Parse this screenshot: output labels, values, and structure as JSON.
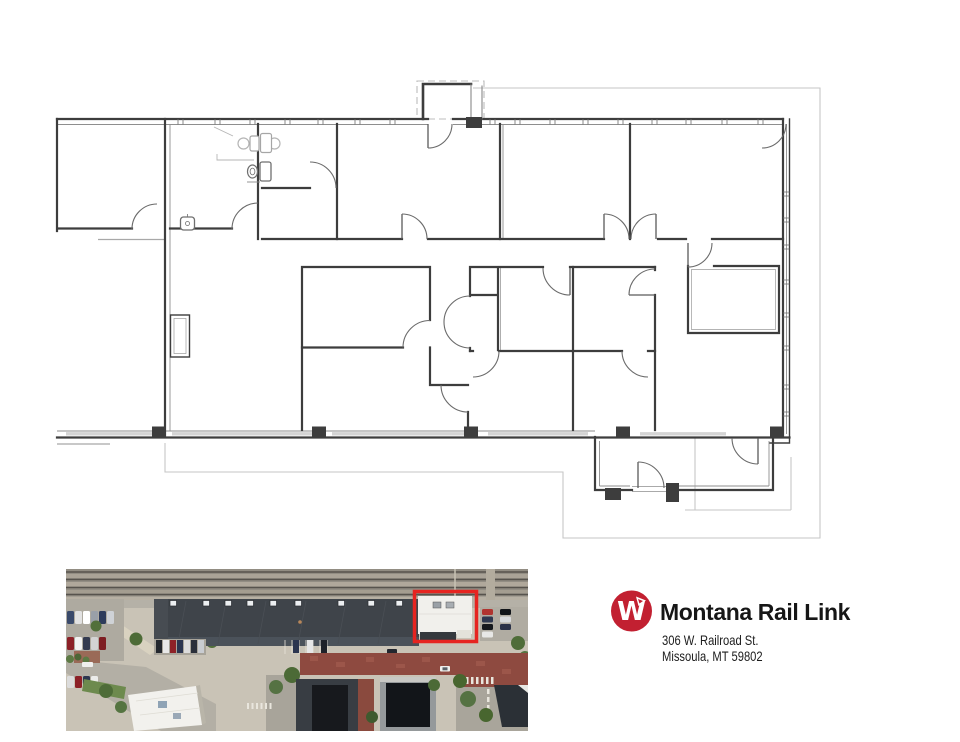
{
  "document": {
    "type": "commercial-floor-plan-flyer"
  },
  "logo": {
    "company": "Montana Rail Link",
    "monogram": "W",
    "circle_color": "#c22031",
    "text_color": "#161616"
  },
  "address": {
    "line1": "306 W. Railroad St.",
    "line2": "Missoula, MT 59802"
  },
  "floor_plan": {
    "wall_color": "#3d3d3d",
    "thin_wall_color": "#8e8e8e",
    "door_arc_color": "#6a6a6a",
    "boundary_color": "#c6c6c6",
    "fixture_color": "#b5b5b5"
  },
  "aerial": {
    "highlight_color": "#e62420",
    "depot_roof_color": "#3f444a",
    "subject_roof_color": "#f1f0ec",
    "brick_color": "#8e4a40",
    "railroad_color": "#928d83",
    "pavement_color": "#c9c3b6"
  }
}
